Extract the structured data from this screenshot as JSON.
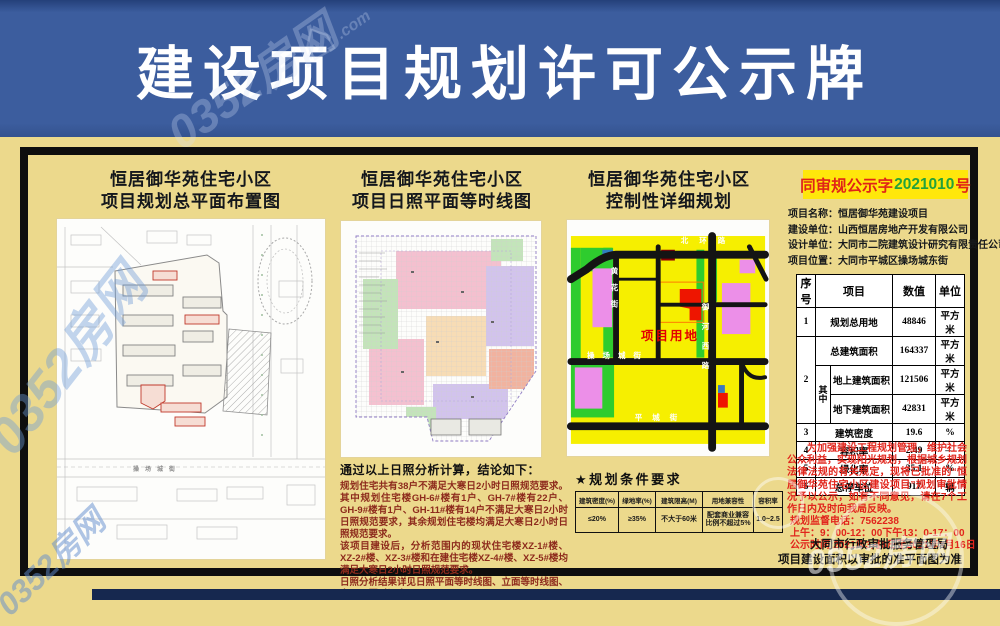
{
  "watermark": {
    "brand": "0352房网",
    "domain": ".com",
    "house_icon": "⌂"
  },
  "header": {
    "title": "建设项目规划许可公示牌"
  },
  "sections": {
    "site_plan": {
      "title1": "恒居御华苑住宅小区",
      "title2": "项目规划总平面布置图",
      "road_label": "操场城街"
    },
    "sunshine": {
      "title1": "恒居御华苑住宅小区",
      "title2": "项目日照平面等时线图"
    },
    "regulatory": {
      "title1": "恒居御华苑住宅小区",
      "title2": "控制性详细规划",
      "labels": {
        "north": "北环路",
        "mid": "操场城街",
        "south": "平城街",
        "east": "御河西路",
        "west": "黄花街",
        "site": "项目用地"
      }
    }
  },
  "conclusion": {
    "heading": "通过以上日照分析计算，结论如下：",
    "p1": "规划住宅共有38户不满足大寒日2小时日照规范要求。其中规划住宅楼GH-6#楼有1户、GH-7#楼有22户、GH-9#楼有1户、GH-11#楼有14户不满足大寒日2小时日照规范要求，其余规划住宅楼均满足大寒日2小时日照规范要求。",
    "p2": "该项目建设后，分析范围内的现状住宅楼XZ-1#楼、XZ-2#楼、XZ-3#楼和在建住宅楼XZ-4#楼、XZ-5#楼均满足大寒日2小时日照规范要求。",
    "p3": "日照分析结果详见日照平面等时线图、立面等时线图、窗口日照时间表。"
  },
  "planning_conditions": {
    "heading": "★规划条件要求",
    "headers": [
      "建筑密度(%)",
      "绿地率(%)",
      "建筑限高(M)",
      "用地兼容性",
      "容积率"
    ],
    "values": [
      "≤20%",
      "≥35%",
      "不大于60米",
      "配套商业兼容比例不超过5%",
      "1.0~2.5"
    ]
  },
  "permit": {
    "doc_no_prefix": "同审规公示字",
    "doc_no_number": "2021010",
    "doc_no_suffix": "号",
    "info": [
      {
        "label": "项目名称：",
        "value": "恒居御华苑建设项目"
      },
      {
        "label": "建设单位：",
        "value": "山西恒居房地产开发有限公司"
      },
      {
        "label": "设计单位：",
        "value": "大同市二院建筑设计研究有限责任公司"
      },
      {
        "label": "项目位置：",
        "value": "大同市平城区操场城东街"
      }
    ]
  },
  "main_table": {
    "headers": {
      "no": "序号",
      "item": "项目",
      "value": "数值",
      "unit": "单位"
    },
    "zhong": "其中",
    "rows": [
      {
        "no": "1",
        "item": "规划总用地",
        "value": "48846",
        "unit": "平方米"
      },
      {
        "no": "2",
        "item": "总建筑面积",
        "value": "164337",
        "unit": "平方米"
      },
      {
        "item": "地上建筑面积",
        "value": "121506",
        "unit": "平方米"
      },
      {
        "item": "地下建筑面积",
        "value": "42831",
        "unit": "平方米"
      },
      {
        "no": "3",
        "item": "建筑密度",
        "value": "19.6",
        "unit": "%"
      },
      {
        "no": "4",
        "item": "容积率",
        "value": "2.49",
        "unit": "—"
      },
      {
        "no": "5",
        "item": "绿化率",
        "value": "35.1",
        "unit": "%"
      },
      {
        "no": "6",
        "item": "总停车位",
        "value": "917",
        "unit": "辆"
      }
    ]
  },
  "notice": {
    "body": "为加强建设工程规划管理，维护社会公众利益，实现阳光规划，根据城乡规划法律法规的有关规定，现将已批准的“恒居御华苑住宅小区建设项目”规划审批情况予以公示，如有不同意见，请在7个工作日内及时向我局反映。",
    "phone": "规划监督电话：7562238",
    "hours": "上午：9：00-12：00下午13：0-17：00",
    "period": "公示时间:2021年3月8日至2021年3月16日",
    "agency": "大同市行政审批服务管理局",
    "footnote": "项目建设面积以审批的准平面图为准"
  },
  "colors": {
    "header_blue": "#3c5d9e",
    "board_cream": "#ecd98c",
    "highlight_yellow": "#ffe70b",
    "notice_red": "#e1251c",
    "doc_green": "#23a23b",
    "zoning_yellow": "#f6ef00",
    "zoning_green": "#2ecc2e",
    "zoning_magenta": "#ec8fe8",
    "zoning_red": "#ee1500"
  }
}
